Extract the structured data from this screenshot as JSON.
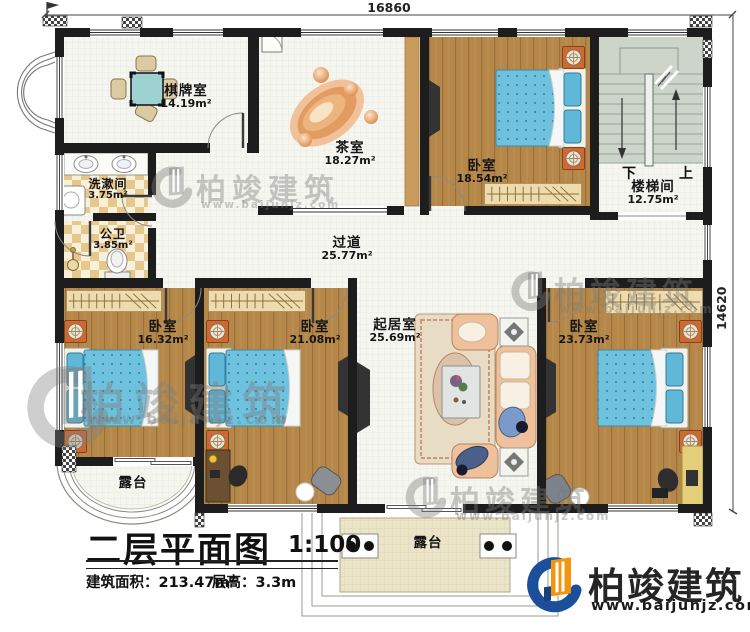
{
  "dimensions": {
    "top": "16860",
    "right": "14620"
  },
  "rooms": {
    "chess": {
      "name": "棋牌室",
      "area": "14.19m²"
    },
    "tea": {
      "name": "茶室",
      "area": "18.27m²"
    },
    "bedroom_top": {
      "name": "卧室",
      "area": "18.54m²"
    },
    "stairwell": {
      "name": "楼梯间",
      "area": "12.75m²"
    },
    "washroom": {
      "name": "洗漱间",
      "area": "3.75m²"
    },
    "toilet": {
      "name": "公卫",
      "area": "3.85m²"
    },
    "corridor": {
      "name": "过道",
      "area": "25.77m²"
    },
    "bedroom_left": {
      "name": "卧室",
      "area": "16.32m²"
    },
    "bedroom_mid": {
      "name": "卧室",
      "area": "21.08m²"
    },
    "living": {
      "name": "起居室",
      "area": "25.69m²"
    },
    "bedroom_right": {
      "name": "卧室",
      "area": "23.73m²"
    },
    "terrace_left": {
      "name": "露台"
    },
    "terrace_center": {
      "name": "露台"
    }
  },
  "stairs": {
    "down_label": "下",
    "up_label": "上"
  },
  "titleblock": {
    "title": "二层平面图",
    "scale": "1:100",
    "area": "建筑面积：213.47m²",
    "floor_height": "层高：3.3m"
  },
  "brand": {
    "name": "柏竣建筑",
    "url": "www.baijunjz.com"
  },
  "watermark": {
    "name": "柏竣建筑",
    "url": "www.baijunjz.com"
  },
  "colors": {
    "wall": "#1d1d1d",
    "wood": "#b5884a",
    "bed_blue": "#6fc2de",
    "nightstand": "#c96a35",
    "brand_blue": "#1b4e9b",
    "brand_orange": "#f2960f"
  }
}
